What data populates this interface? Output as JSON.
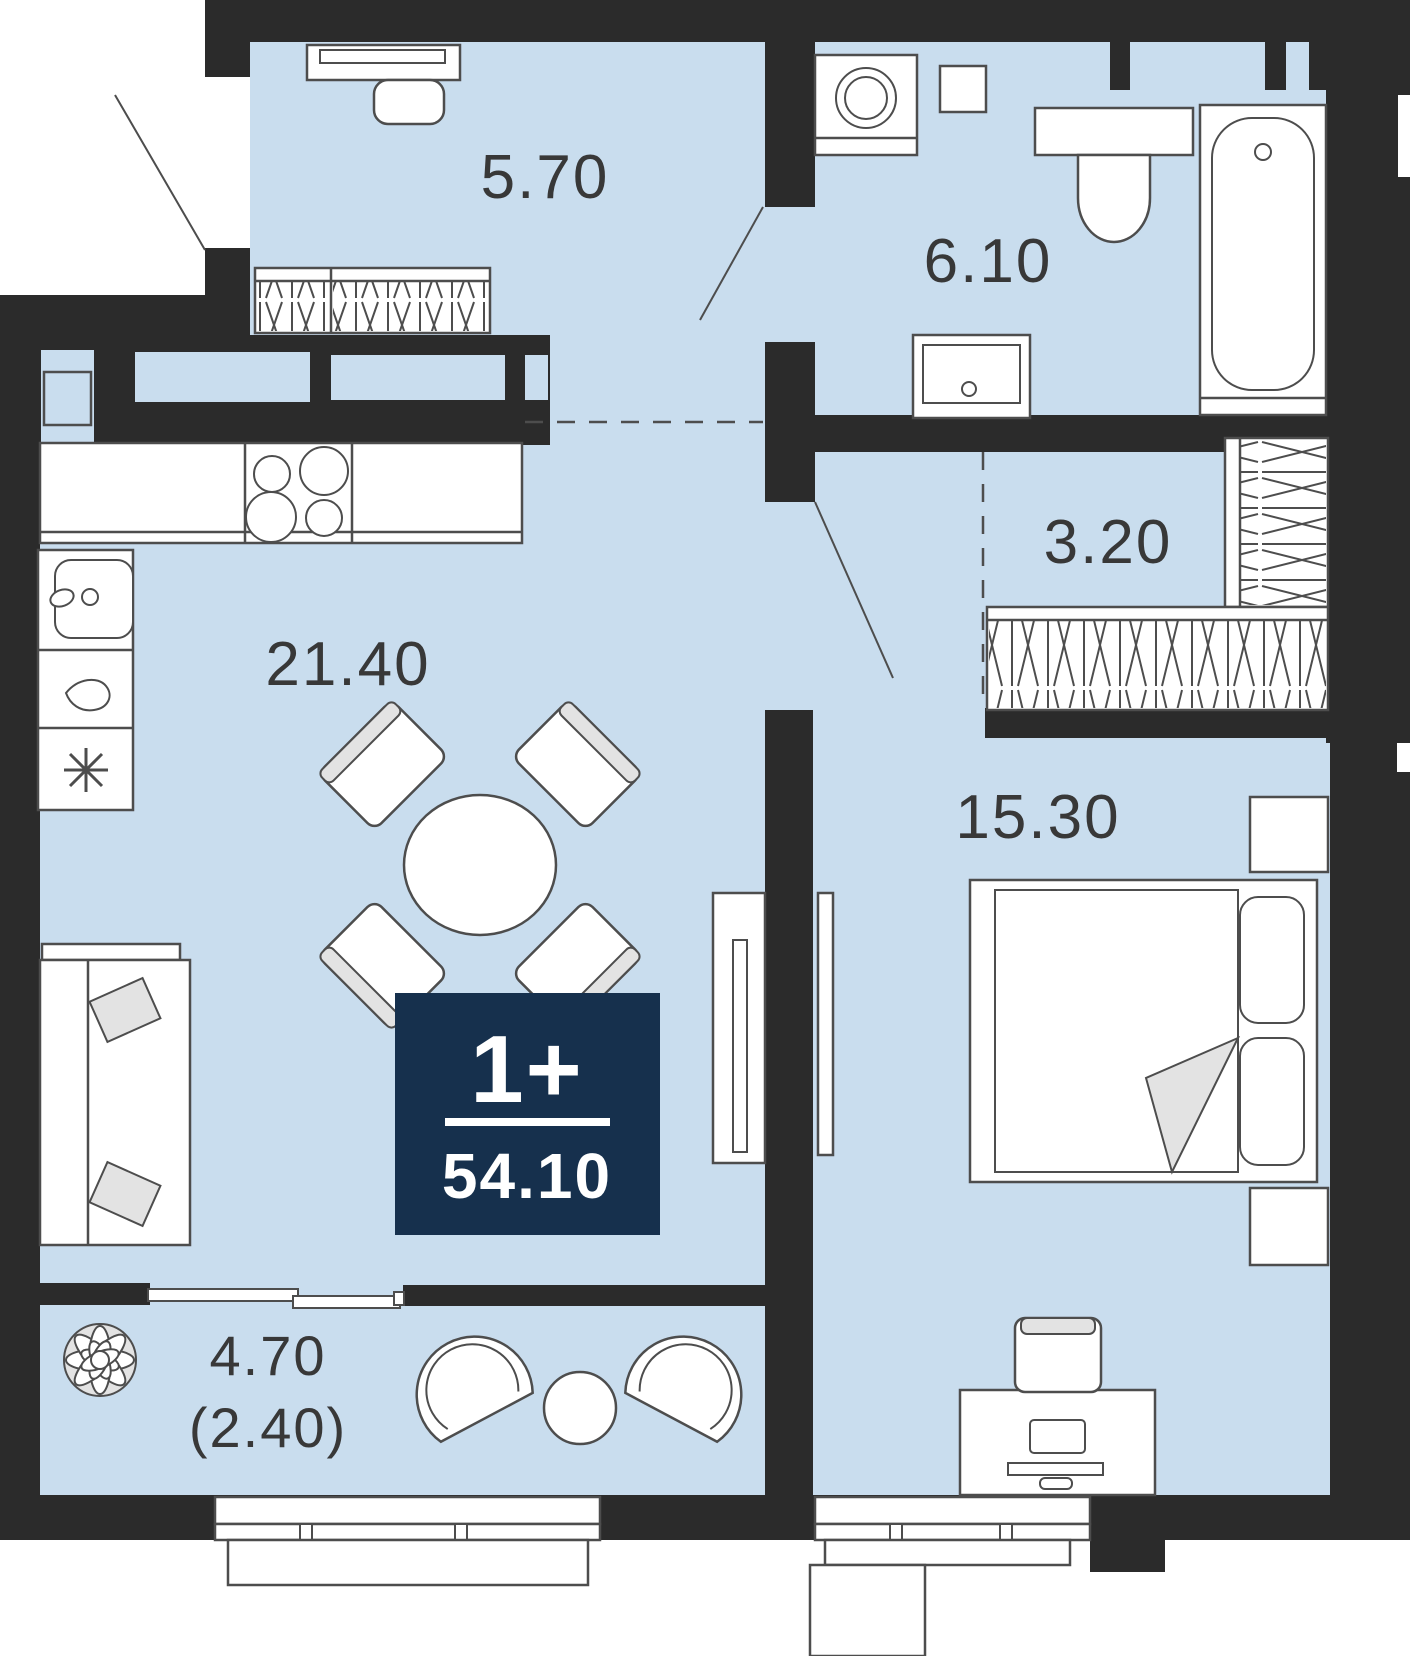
{
  "colors": {
    "floor": "#c9ddee",
    "wall": "#2b2b2b",
    "line": "#4d4d4d",
    "badge_bg": "#16304d",
    "badge_text": "#ffffff",
    "label_text": "#383838"
  },
  "badge": {
    "rooms": "1+",
    "total_area": "54.10"
  },
  "rooms": {
    "hallway": {
      "area": "5.70"
    },
    "bathroom": {
      "area": "6.10"
    },
    "wardrobe": {
      "area": "3.20"
    },
    "kitchen_living": {
      "area": "21.40"
    },
    "bedroom": {
      "area": "15.30"
    },
    "balcony": {
      "area": "4.70",
      "area_weighted": "(2.40)"
    }
  }
}
